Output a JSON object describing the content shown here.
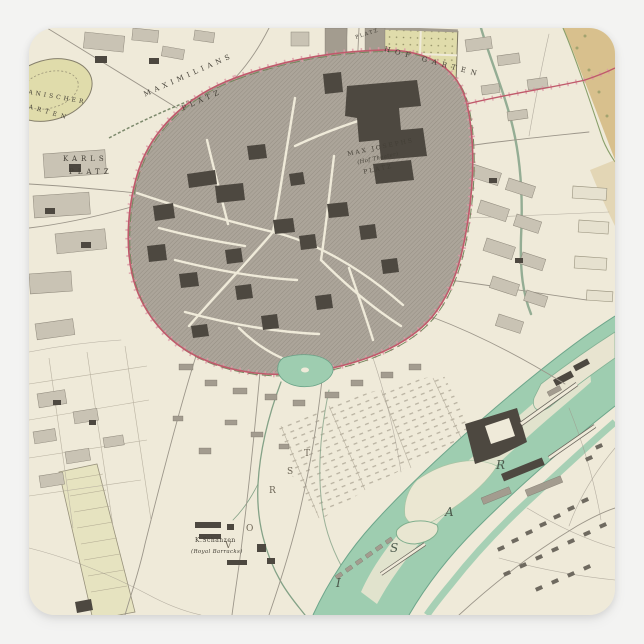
{
  "palette": {
    "background": "#f3f3f2",
    "paper": "#efead9",
    "block_light": "#c9c3b4",
    "block_mid": "#a39c8f",
    "block_dark": "#4d4840",
    "street": "#9c968a",
    "wall_red": "#c05a6b",
    "wall_pink": "#dc9aa6",
    "wall_green": "#75875f",
    "water": "#9ecdb0",
    "river_bed": "#e8e5d0",
    "garden_green": "#e0dcab",
    "garden_tan": "#d3b97f",
    "label_ink": "#433f36"
  },
  "map": {
    "labels": {
      "maximilians_platz": {
        "line1": "MAXIMILIANS",
        "line2": "PLATZ"
      },
      "karls_platz": {
        "line1": "KARLS",
        "line2": "PLATZ"
      },
      "hof_garten": {
        "text": "HOF GARTEN"
      },
      "max_josephs_platz": {
        "line1": "MAX JOSEPHS",
        "line2": "(Hof Theater)",
        "line3": "PLATZ"
      },
      "botanischer_garten": {
        "line1": "BOTANISCHER",
        "line2": "GARTEN"
      },
      "odeons_platz": {
        "text": "PLATZ"
      },
      "schanzen": {
        "line1": "K.Schanzen",
        "line2": "(Royal Barracks)"
      }
    },
    "river_letters": [
      "I",
      "S",
      "A",
      "R"
    ],
    "district_letters": [
      "V",
      "O",
      "R",
      "S",
      "T"
    ]
  }
}
